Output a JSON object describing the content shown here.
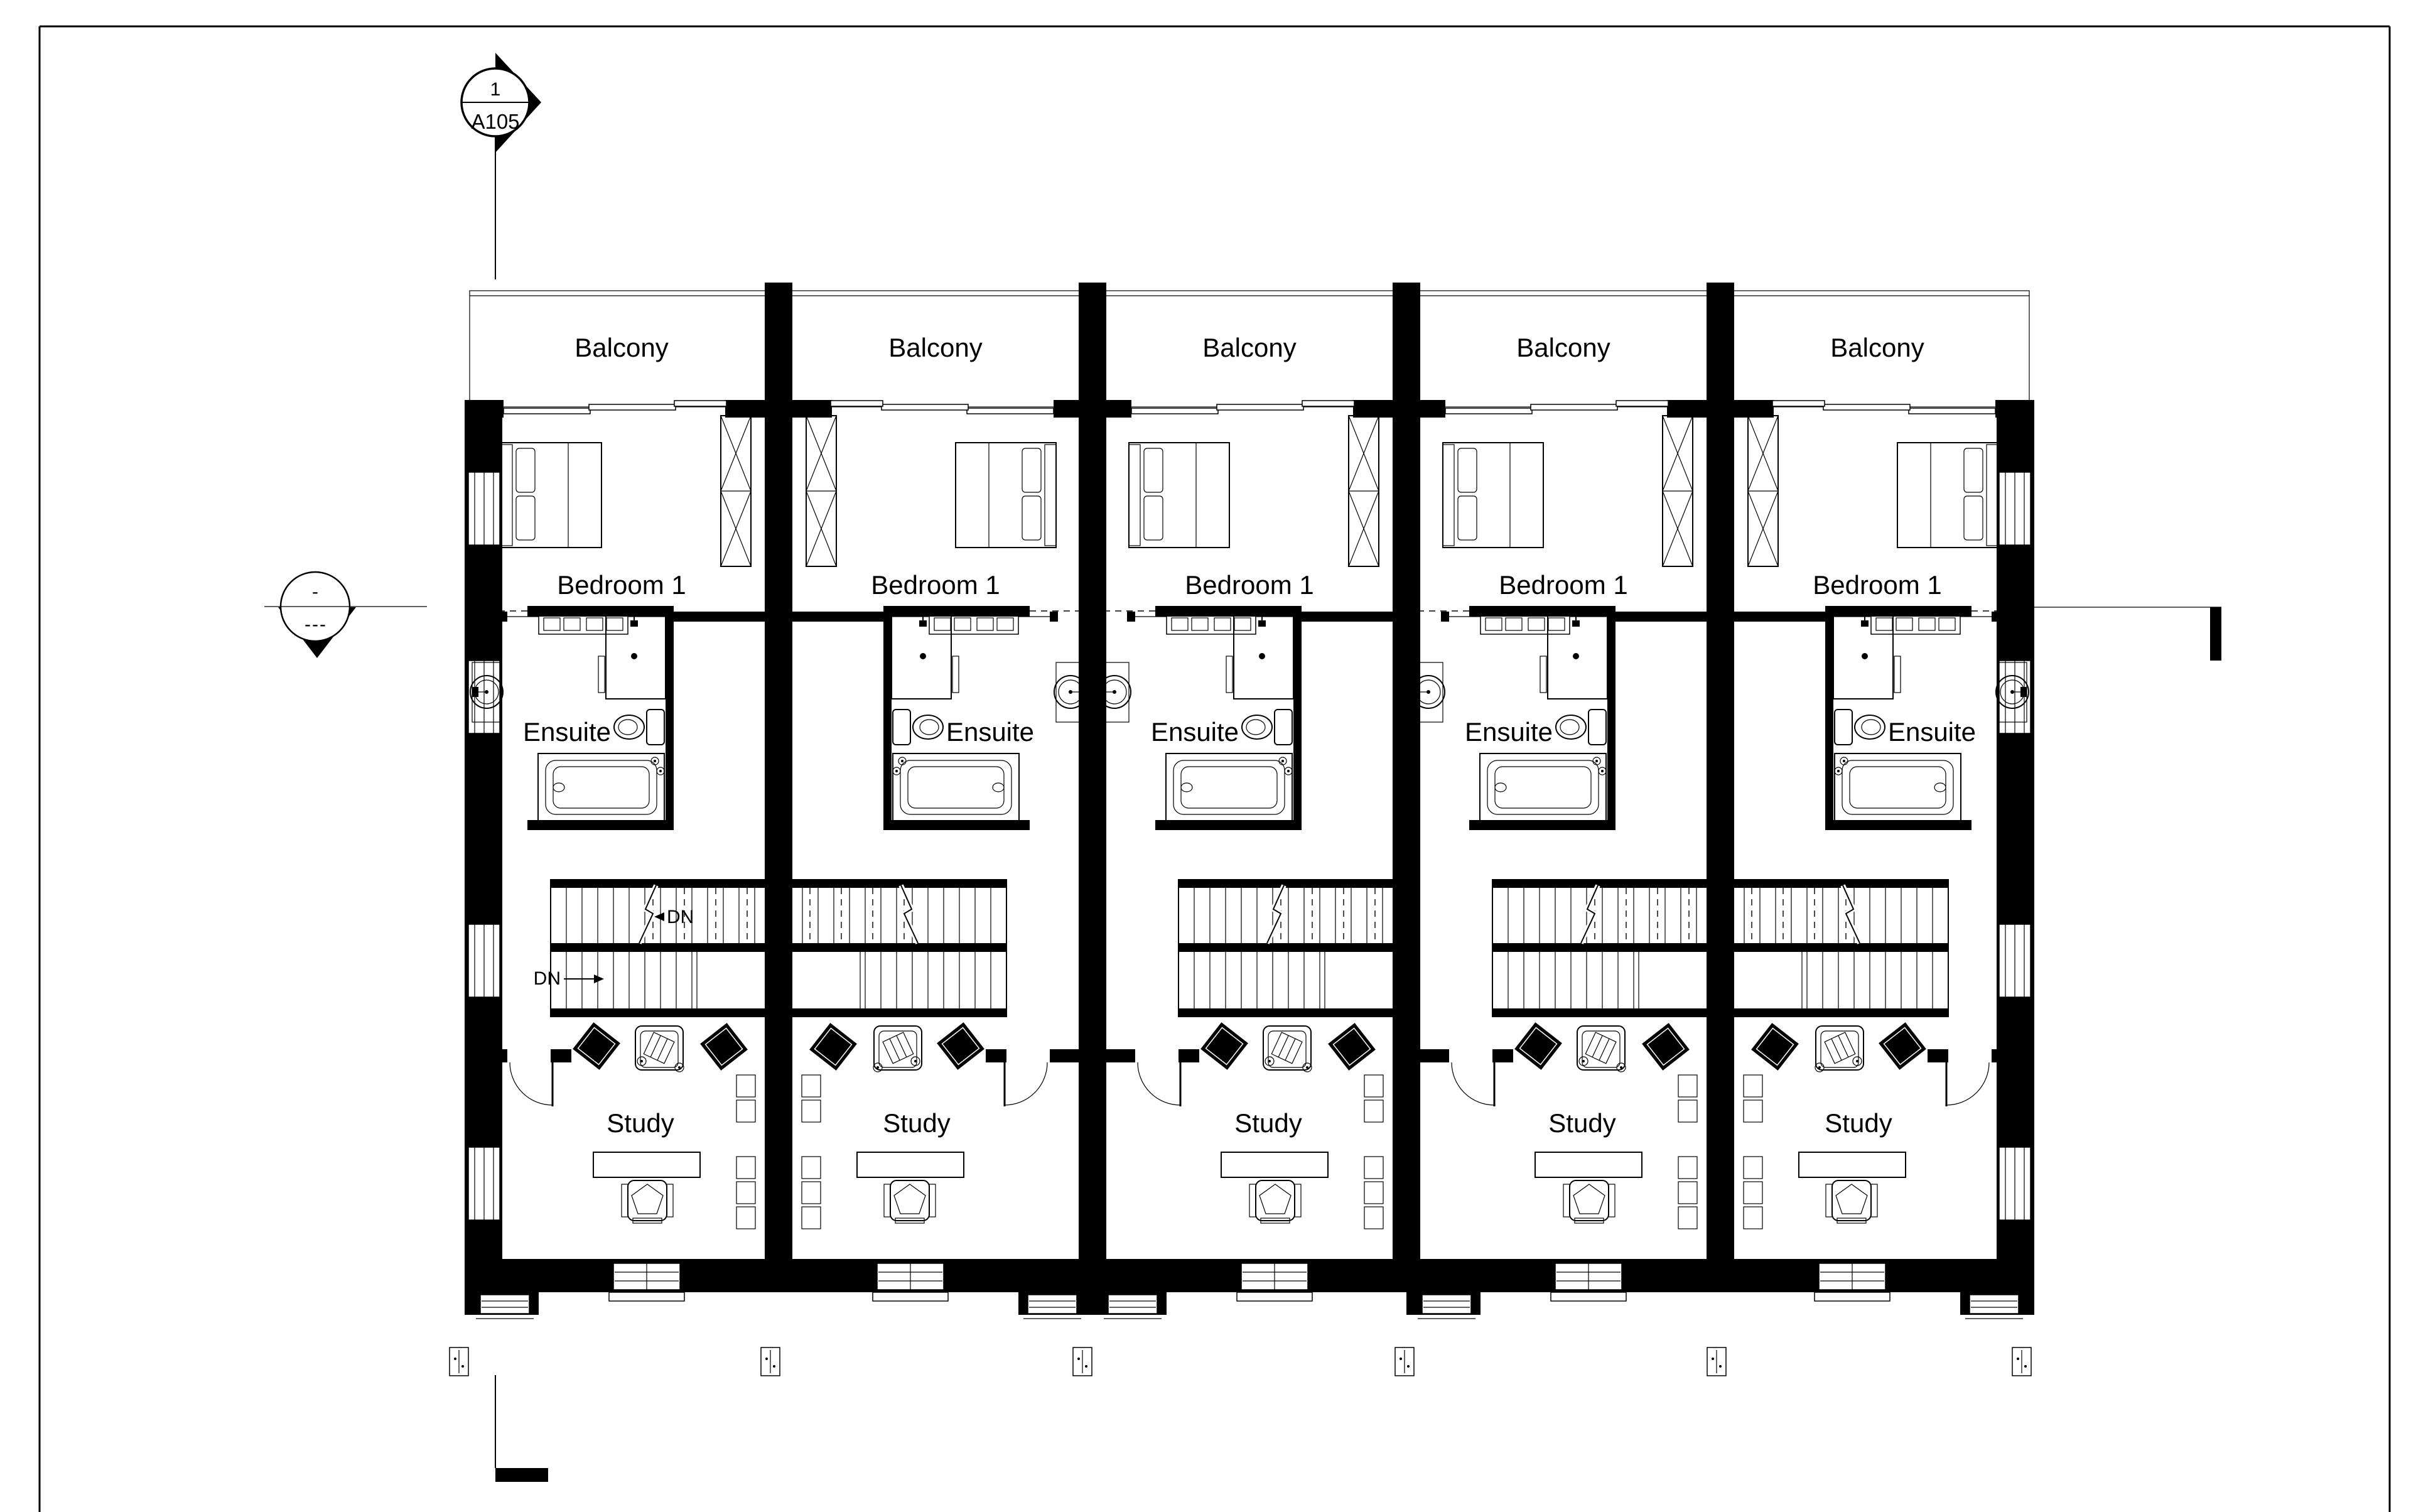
{
  "drawing": {
    "section_marker_top": {
      "detail_number": "1",
      "sheet_number": "A105"
    },
    "level_marker_left": {
      "top_text": "-",
      "bottom_text": "---"
    }
  },
  "units": [
    {
      "name": "unit-1",
      "mirrored": false,
      "rooms": {
        "balcony": "Balcony",
        "bedroom": "Bedroom 1",
        "ensuite": "Ensuite",
        "study": "Study"
      },
      "stairs": {
        "dn_upper": "DN",
        "dn_lower": "DN"
      }
    },
    {
      "name": "unit-2",
      "mirrored": true,
      "rooms": {
        "balcony": "Balcony",
        "bedroom": "Bedroom 1",
        "ensuite": "Ensuite",
        "study": "Study"
      }
    },
    {
      "name": "unit-3",
      "mirrored": false,
      "rooms": {
        "balcony": "Balcony",
        "bedroom": "Bedroom 1",
        "ensuite": "Ensuite",
        "study": "Study"
      }
    },
    {
      "name": "unit-4",
      "mirrored": false,
      "rooms": {
        "balcony": "Balcony",
        "bedroom": "Bedroom 1",
        "ensuite": "Ensuite",
        "study": "Study"
      }
    },
    {
      "name": "unit-5",
      "mirrored": true,
      "rooms": {
        "balcony": "Balcony",
        "bedroom": "Bedroom 1",
        "ensuite": "Ensuite",
        "study": "Study"
      }
    }
  ],
  "colors": {
    "ink": "#000000",
    "paper": "#ffffff"
  }
}
